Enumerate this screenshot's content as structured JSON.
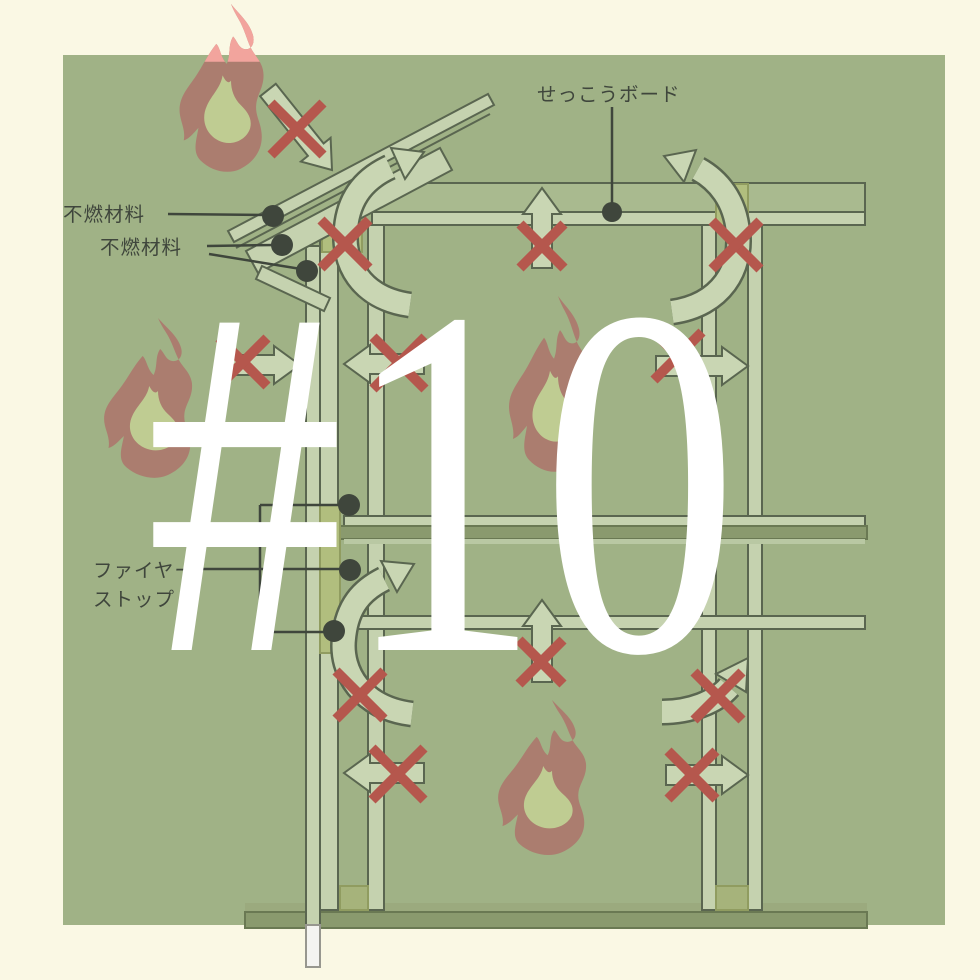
{
  "overlay": {
    "number_label": "#10",
    "color": "#FFFFFF"
  },
  "labels": {
    "gypsum_board": "せっこうボード",
    "noncombustible_1": "不燃材料",
    "noncombustible_2": "不燃材料",
    "fire_stop_line1": "ファイヤー",
    "fire_stop_line2": "ストップ"
  },
  "colors": {
    "page_bg": "#FAF8E4",
    "panel": "#A0B286",
    "outline": "#5A6650",
    "board": "#C5D2AF",
    "board_light": "#B9C8A3",
    "joist": "#A9BA8F",
    "sill_light": "#9BAA7E",
    "sill_dark": "#8A9A6E",
    "sill_stroke": "#6A7953",
    "yellow": "#B1BE7E",
    "yellow_stroke": "#909C60",
    "yellow_dark": "#A6B37B",
    "arrow_fill": "#C9D6B3",
    "x_red": "#B5574D",
    "flame_outer": "#AB7D6F",
    "flame_inner": "#BFCC92",
    "flame_salmon": "#F2A49D",
    "ink": "#3F463C",
    "white_bar": "#F4F4F1",
    "white_bar_stroke": "#97978F"
  },
  "diagram": {
    "panel": {
      "x": 63,
      "y": 55,
      "w": 882,
      "h": 870
    },
    "rects": [
      {
        "x": 372,
        "y": 183,
        "w": 493,
        "h": 29,
        "f": "joist",
        "s": "outline"
      },
      {
        "x": 372,
        "y": 212,
        "w": 493,
        "h": 13,
        "f": "board",
        "s": "outline"
      },
      {
        "x": 245,
        "y": 903,
        "w": 622,
        "h": 9,
        "f": "sill_light",
        "s": "none"
      },
      {
        "x": 245,
        "y": 912,
        "w": 622,
        "h": 16,
        "f": "sill_dark",
        "s": "sill_stroke"
      },
      {
        "x": 306,
        "y": 246,
        "w": 14,
        "h": 679,
        "f": "board",
        "s": "outline"
      },
      {
        "x": 320,
        "y": 230,
        "w": 18,
        "h": 680,
        "f": "board",
        "s": "outline"
      },
      {
        "x": 368,
        "y": 225,
        "w": 16,
        "h": 685,
        "f": "board",
        "s": "outline"
      },
      {
        "x": 702,
        "y": 225,
        "w": 14,
        "h": 685,
        "f": "board",
        "s": "outline"
      },
      {
        "x": 748,
        "y": 225,
        "w": 14,
        "h": 685,
        "f": "board",
        "s": "outline"
      },
      {
        "x": 344,
        "y": 516,
        "w": 521,
        "h": 10,
        "f": "board",
        "s": "outline"
      },
      {
        "x": 245,
        "y": 526,
        "w": 622,
        "h": 13,
        "f": "sill_dark",
        "s": "sill_stroke"
      },
      {
        "x": 344,
        "y": 539,
        "w": 521,
        "h": 5,
        "f": "board_light",
        "s": "none"
      },
      {
        "x": 356,
        "y": 616,
        "w": 509,
        "h": 13,
        "f": "board",
        "s": "outline"
      },
      {
        "x": 320,
        "y": 505,
        "w": 20,
        "h": 148,
        "f": "yellow",
        "s": "yellow_stroke"
      },
      {
        "x": 322,
        "y": 214,
        "w": 40,
        "h": 38,
        "f": "yellow",
        "s": "yellow_stroke"
      },
      {
        "x": 716,
        "y": 184,
        "w": 32,
        "h": 46,
        "f": "yellow",
        "s": "yellow_stroke"
      },
      {
        "x": 340,
        "y": 886,
        "w": 28,
        "h": 24,
        "f": "yellow_dark",
        "s": "yellow_stroke"
      },
      {
        "x": 716,
        "y": 886,
        "w": 32,
        "h": 24,
        "f": "yellow_dark",
        "s": "yellow_stroke"
      },
      {
        "x": 306,
        "y": 925,
        "w": 14,
        "h": 42,
        "f": "white_bar",
        "s": "white_bar_stroke"
      }
    ],
    "roof_polys": [
      {
        "pts": "228,231 488,94 494,105 234,242",
        "f": "board",
        "s": "outline"
      },
      {
        "pts": "246,251 440,148 452,170 258,273",
        "f": "board",
        "s": "outline"
      },
      {
        "pts": "262,266 330,298 324,311 256,279",
        "f": "board",
        "s": "outline"
      }
    ],
    "roof_lines": [
      {
        "x1": 236,
        "y1": 248,
        "x2": 490,
        "y2": 114
      }
    ],
    "straight_arrows": [
      {
        "x1": 268,
        "y1": 90,
        "x2": 332,
        "y2": 170
      },
      {
        "x1": 542,
        "y1": 268,
        "x2": 542,
        "y2": 188
      },
      {
        "x1": 218,
        "y1": 365,
        "x2": 300,
        "y2": 365
      },
      {
        "x1": 424,
        "y1": 364,
        "x2": 344,
        "y2": 364
      },
      {
        "x1": 656,
        "y1": 366,
        "x2": 748,
        "y2": 366
      },
      {
        "x1": 424,
        "y1": 773,
        "x2": 344,
        "y2": 773
      },
      {
        "x1": 542,
        "y1": 682,
        "x2": 542,
        "y2": 600
      },
      {
        "x1": 666,
        "y1": 775,
        "x2": 748,
        "y2": 775
      }
    ],
    "curved_arrows": [
      {
        "path": "M410,305 C360,298 342,262 346,228 C349,196 366,178 390,167",
        "head": "424,152 405,179 391,148"
      },
      {
        "path": "M672,312 C722,305 742,268 738,232 C735,200 718,180 698,169",
        "head": "664,156 684,182 696,150"
      },
      {
        "path": "M412,714 C362,708 340,672 344,638 C347,606 362,590 384,579",
        "head": "414,564 397,592 381,561"
      },
      {
        "path": "M662,712 C690,712 716,702 729,687",
        "head": "748,658 746,692 716,674"
      }
    ],
    "x_marks": [
      {
        "x": 297,
        "y": 129,
        "s": 26
      },
      {
        "x": 345,
        "y": 244,
        "s": 24
      },
      {
        "x": 542,
        "y": 246,
        "s": 22
      },
      {
        "x": 736,
        "y": 245,
        "s": 24
      },
      {
        "x": 243,
        "y": 362,
        "s": 24
      },
      {
        "x": 399,
        "y": 363,
        "s": 26
      },
      {
        "x": 678,
        "y": 356,
        "s": 24
      },
      {
        "x": 360,
        "y": 695,
        "s": 24
      },
      {
        "x": 398,
        "y": 774,
        "s": 26
      },
      {
        "x": 541,
        "y": 662,
        "s": 22
      },
      {
        "x": 718,
        "y": 696,
        "s": 24
      },
      {
        "x": 692,
        "y": 775,
        "s": 24
      }
    ],
    "leader_lines": [
      {
        "x1": 168,
        "y1": 214,
        "x2": 266,
        "y2": 215
      },
      {
        "x1": 207,
        "y1": 246,
        "x2": 274,
        "y2": 245
      },
      {
        "x1": 209,
        "y1": 254,
        "x2": 301,
        "y2": 269
      },
      {
        "x1": 612,
        "y1": 107,
        "x2": 612,
        "y2": 206
      },
      {
        "x1": 187,
        "y1": 569,
        "x2": 349,
        "y2": 569
      },
      {
        "x1": 260,
        "y1": 505,
        "x2": 260,
        "y2": 632
      },
      {
        "x1": 260,
        "y1": 505,
        "x2": 343,
        "y2": 505
      },
      {
        "x1": 260,
        "y1": 632,
        "x2": 328,
        "y2": 632
      }
    ],
    "dots": [
      {
        "x": 273,
        "y": 216,
        "r": 11
      },
      {
        "x": 282,
        "y": 245,
        "r": 11
      },
      {
        "x": 307,
        "y": 271,
        "r": 11
      },
      {
        "x": 612,
        "y": 212,
        "r": 10
      },
      {
        "x": 349,
        "y": 505,
        "r": 11
      },
      {
        "x": 350,
        "y": 570,
        "r": 11
      },
      {
        "x": 334,
        "y": 631,
        "r": 11
      }
    ],
    "flames": [
      {
        "x": 168,
        "y": 4,
        "sx": 1.05,
        "sy": 1.05,
        "salmon_top": true
      },
      {
        "x": 92,
        "y": 318,
        "sx": 1.1,
        "sy": 1.0
      },
      {
        "x": 498,
        "y": 296,
        "sx": 1.0,
        "sy": 1.1
      },
      {
        "x": 486,
        "y": 700,
        "sx": 1.1,
        "sy": 0.97
      }
    ],
    "flame_outer_path": "M60,0 C68,10 78,18 81,30 C83,38 79,44 73,43 C67,42 66,35 62,31 C57,39 60,48 56,57 C50,51 50,42 46,38 C38,48 33,59 27,68 C19,80 11,88 11,101 C11,111 17,119 15,130 C21,128 25,122 29,118 C27,130 23,141 31,149 C41,159 57,163 69,157 C83,150 91,137 89,122 C88,112 83,106 84,96 C85,86 91,80 91,68 C91,56 83,50 79,42 C75,34 73,24 67,14 C64,9 62,5 60,0 Z",
    "flame_inner_path": "M52,68 C50,80 42,86 37,97 C31,110 36,124 48,130 C60,136 74,130 78,119 C81,109 75,102 69,96 C63,90 60,82 60,73 C57,77 54,72 52,68 Z",
    "panel_top_edge": 55
  }
}
